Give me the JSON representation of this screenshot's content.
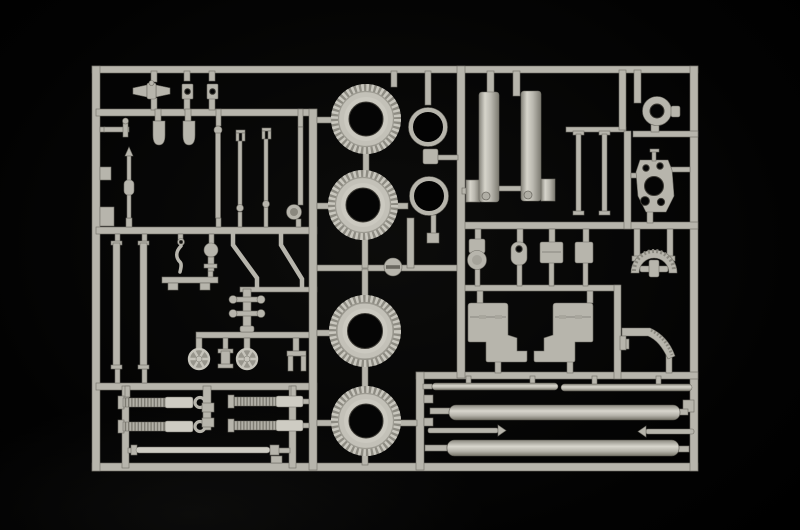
{
  "scene": {
    "description": "Photograph of an unpainted light grey injection-moulded plastic model kit sprue (parts tree) lying on a black studio background",
    "background": "black studio sweep",
    "material": "light grey styrene plastic"
  },
  "colors": {
    "background": "#000000",
    "plastic": "#b7b5ac",
    "plastic_light": "#ceccc3",
    "plastic_dark": "#8a887f",
    "plastic_deep": "#6f6d65",
    "tire_side": "#c3c1b8",
    "tire_tread_base": "#8e8c83",
    "hole": "#050505"
  },
  "parts": {
    "tires": {
      "label": "ribbed road tires",
      "count": 4
    },
    "rings": {
      "label": "open hoop rings",
      "count": 2
    },
    "recuperator_cylinders": {
      "label": "large vertical cylinders with foot plates",
      "count": 2
    },
    "long_tubes": {
      "label": "thick horizontal barrel tubes",
      "count": 2
    },
    "thin_tubes": {
      "label": "thin horizontal tubes",
      "count": 2
    },
    "pointed_rods": {
      "label": "pointed cleaning rods",
      "count": 2
    },
    "shock_absorbers": {
      "label": "coil-spring shock absorber cylinders",
      "count": 4
    },
    "handwheels": {
      "label": "spoked elevation handwheels",
      "count": 2
    },
    "trail_plates": {
      "label": "flat stepped trail plates",
      "count": 2
    },
    "mount_bracket": {
      "label": "drilled cradle bracket",
      "count": 1
    },
    "hub_ring": {
      "label": "round hub with centre bore",
      "count": 1
    },
    "arc_segment": {
      "label": "toothed arch segment",
      "count": 1
    },
    "quarter_sector": {
      "label": "curved gear quarter sector",
      "count": 1
    },
    "clevis_rods": {
      "label": "thin clevis link rods",
      "count": 3
    },
    "small_fittings": {
      "label": "assorted small fittings, levers and plates",
      "count": 22
    }
  }
}
